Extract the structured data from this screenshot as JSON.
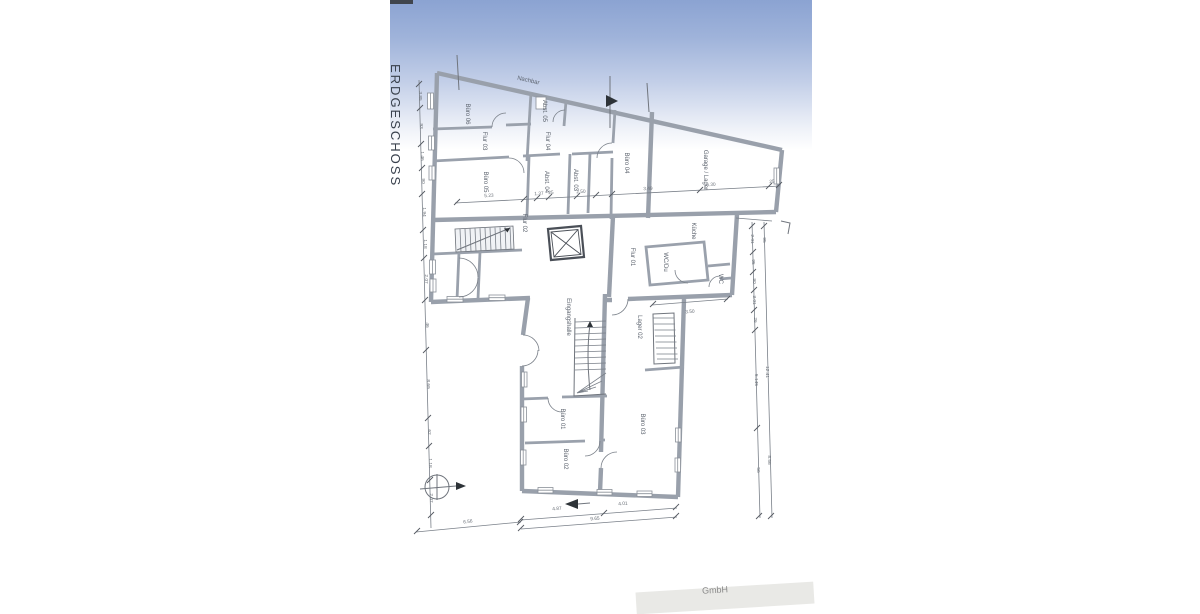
{
  "document": {
    "title_vertical": "ERDGESCHOSS",
    "footer_fragment": "GmbH"
  },
  "colors": {
    "sky_top": "#8ba3d2",
    "sky_mid": "#c3cfe8",
    "paper": "#ffffff",
    "wall_gray": "#99a0ab",
    "line_gray": "#70757d",
    "label_gray": "#5c636e"
  },
  "plan_labels": {
    "boundary": [
      {
        "id": "nachbar",
        "label": "Nachbar",
        "x": 528,
        "y": 82,
        "rot": 13,
        "size": 6
      }
    ],
    "rooms": [
      {
        "id": "buero-06",
        "label": "Büro 06",
        "x": 466,
        "y": 114,
        "rot": 90
      },
      {
        "id": "abst-05",
        "label": "Abst. 05",
        "x": 543,
        "y": 111,
        "rot": 90
      },
      {
        "id": "flur-03",
        "label": "Flur 03",
        "x": 483,
        "y": 141,
        "rot": 90
      },
      {
        "id": "flur-04",
        "label": "Flur 04",
        "x": 546,
        "y": 141,
        "rot": 90
      },
      {
        "id": "buero-05",
        "label": "Büro 05",
        "x": 484,
        "y": 182,
        "rot": 90
      },
      {
        "id": "abst-04",
        "label": "Abst. 04",
        "x": 545,
        "y": 182,
        "rot": 90
      },
      {
        "id": "abst-03",
        "label": "Abst. 03",
        "x": 574,
        "y": 180,
        "rot": 90
      },
      {
        "id": "buero-04",
        "label": "Büro 04",
        "x": 625,
        "y": 163,
        "rot": 90
      },
      {
        "id": "garage-lager",
        "label": "Garage / Lager",
        "x": 704,
        "y": 170,
        "rot": 90
      },
      {
        "id": "flur-02",
        "label": "Flur 02",
        "x": 523,
        "y": 223,
        "rot": 90
      },
      {
        "id": "kueche",
        "label": "Küche",
        "x": 692,
        "y": 231,
        "rot": 90
      },
      {
        "id": "flur-01",
        "label": "Flur 01",
        "x": 631,
        "y": 257,
        "rot": 90
      },
      {
        "id": "wc-du",
        "label": "WC/Du",
        "x": 664,
        "y": 262,
        "rot": 90
      },
      {
        "id": "wc",
        "label": "WC",
        "x": 719,
        "y": 279,
        "rot": 90
      },
      {
        "id": "eingangshalle",
        "label": "Eingangshalle",
        "x": 567,
        "y": 317,
        "rot": 90
      },
      {
        "id": "lager-02",
        "label": "Lager 02",
        "x": 638,
        "y": 327,
        "rot": 90
      },
      {
        "id": "buero-01",
        "label": "Büro 01",
        "x": 561,
        "y": 419,
        "rot": 90
      },
      {
        "id": "buero-02",
        "label": "Büro 02",
        "x": 564,
        "y": 459,
        "rot": 90
      },
      {
        "id": "buero-03",
        "label": "Büro 03",
        "x": 641,
        "y": 424,
        "rot": 90
      }
    ],
    "dims": [
      {
        "label": "5.23",
        "x": 489,
        "y": 197,
        "rot": -3
      },
      {
        "label": "1.37",
        "x": 539,
        "y": 195,
        "rot": -3
      },
      {
        "label": "25",
        "x": 551,
        "y": 194,
        "rot": -3
      },
      {
        "label": "2.50",
        "x": 581,
        "y": 193,
        "rot": -3
      },
      {
        "label": "3.49",
        "x": 648,
        "y": 190,
        "rot": -3
      },
      {
        "label": "6.30",
        "x": 711,
        "y": 186,
        "rot": -3
      },
      {
        "label": "25",
        "x": 772,
        "y": 183,
        "rot": -3
      },
      {
        "label": "3.50",
        "x": 690,
        "y": 313,
        "rot": -4
      },
      {
        "label": "6.56",
        "x": 468,
        "y": 523,
        "rot": -6
      },
      {
        "label": "4.87",
        "x": 557,
        "y": 510,
        "rot": -4
      },
      {
        "label": "4.01",
        "x": 623,
        "y": 505,
        "rot": -4
      },
      {
        "label": "9.65",
        "x": 595,
        "y": 520,
        "rot": -4
      },
      {
        "label": "3.85",
        "x": 419,
        "y": 96,
        "rot": 90
      },
      {
        "label": "93",
        "x": 420,
        "y": 126,
        "rot": 90
      },
      {
        "label": "1.46",
        "x": 421,
        "y": 156,
        "rot": 90
      },
      {
        "label": "90",
        "x": 422,
        "y": 181,
        "rot": 90
      },
      {
        "label": "1.94",
        "x": 423,
        "y": 212,
        "rot": 90
      },
      {
        "label": "1.18",
        "x": 424,
        "y": 244,
        "rot": 90
      },
      {
        "label": "2.07",
        "x": 425,
        "y": 279,
        "rot": 90
      },
      {
        "label": "46",
        "x": 426,
        "y": 325,
        "rot": 90
      },
      {
        "label": "8.69",
        "x": 427,
        "y": 384,
        "rot": 90
      },
      {
        "label": "62",
        "x": 428,
        "y": 432,
        "rot": 90
      },
      {
        "label": "1.18",
        "x": 429,
        "y": 463,
        "rot": 90
      },
      {
        "label": "2.07",
        "x": 430,
        "y": 498,
        "rot": 90
      },
      {
        "label": "2.01",
        "x": 751,
        "y": 239,
        "rot": 90
      },
      {
        "label": "95",
        "x": 752,
        "y": 262,
        "rot": 90
      },
      {
        "label": "90",
        "x": 753,
        "y": 281,
        "rot": 90
      },
      {
        "label": "3.01",
        "x": 753,
        "y": 300,
        "rot": 90
      },
      {
        "label": "26",
        "x": 754,
        "y": 320,
        "rot": 90
      },
      {
        "label": "5.145",
        "x": 755,
        "y": 380,
        "rot": 90
      },
      {
        "label": "56",
        "x": 757,
        "y": 470,
        "rot": 90
      },
      {
        "label": "95",
        "x": 763,
        "y": 240,
        "rot": 90
      },
      {
        "label": "12.41",
        "x": 766,
        "y": 372,
        "rot": 90
      },
      {
        "label": "8.56",
        "x": 768,
        "y": 460,
        "rot": 90
      }
    ]
  }
}
